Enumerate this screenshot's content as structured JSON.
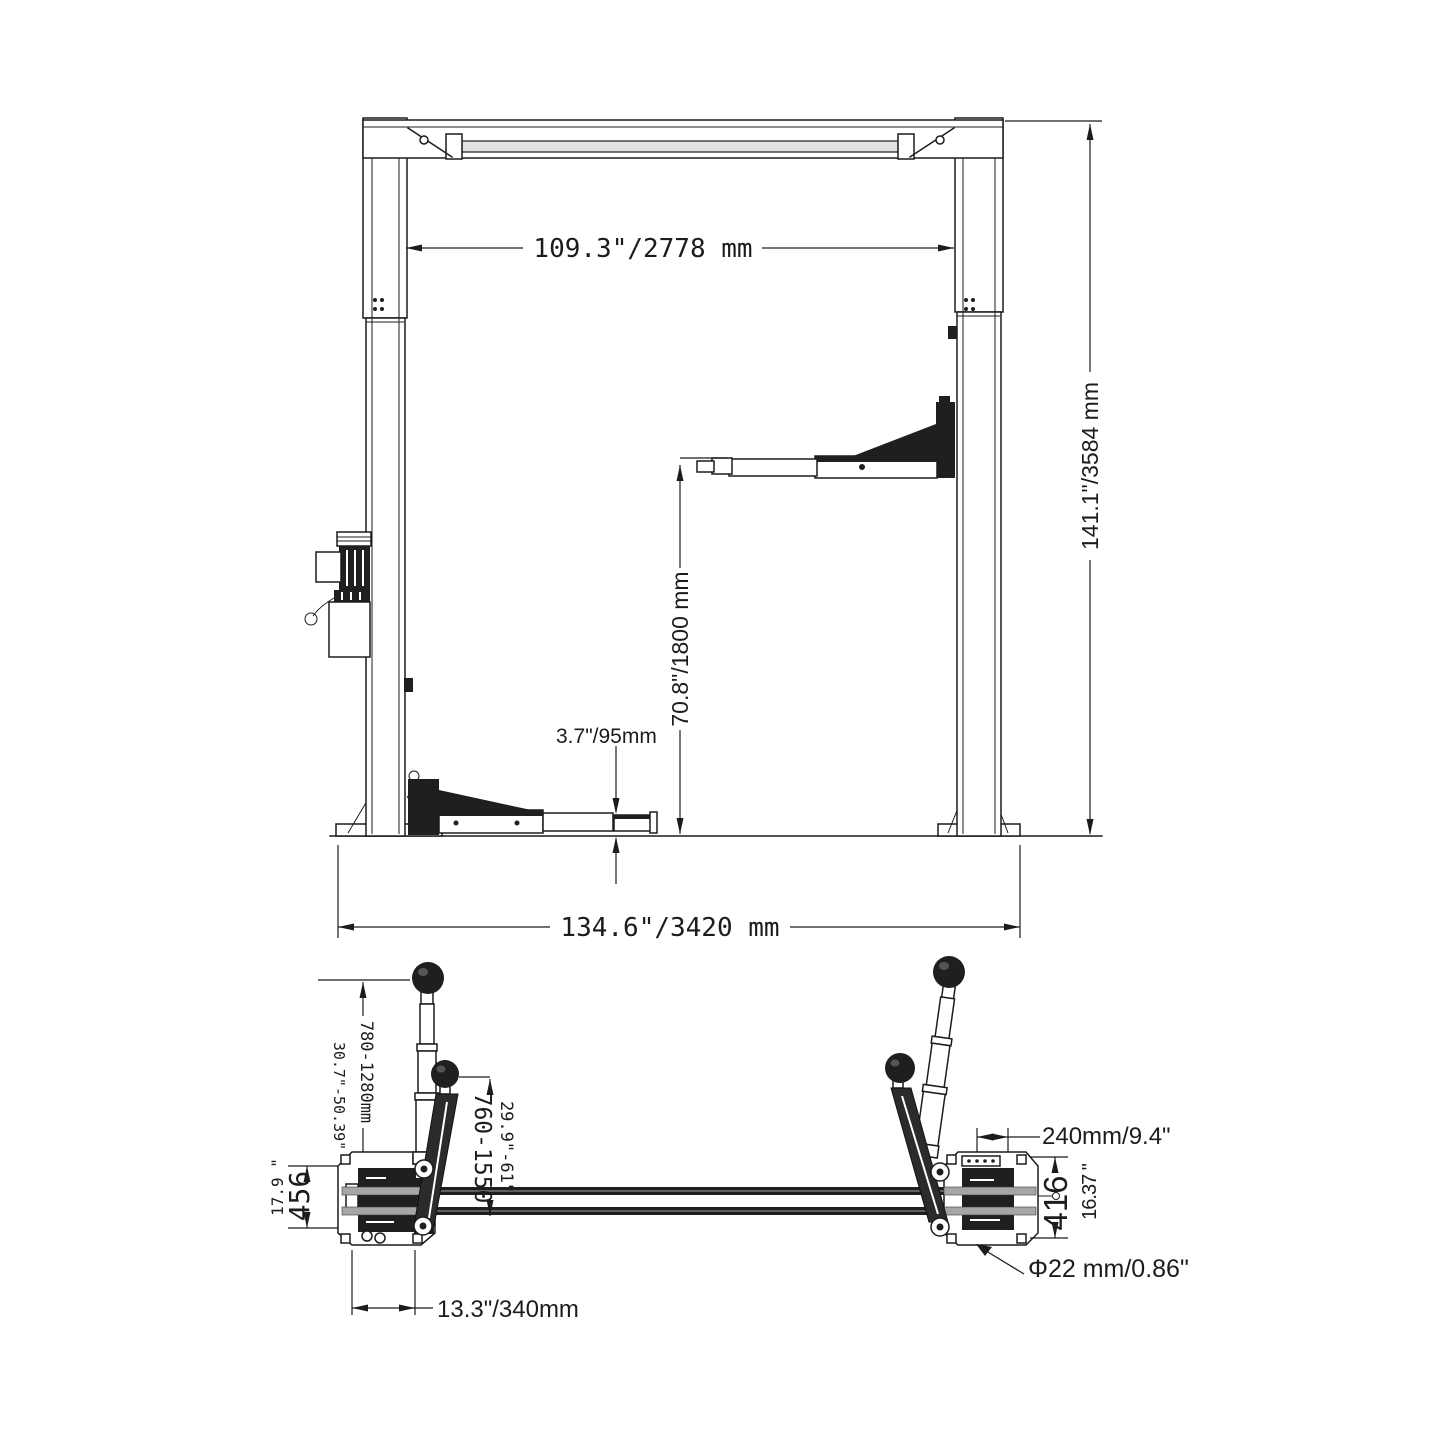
{
  "drawing": {
    "colors": {
      "line": "#1c1c1c",
      "dark_fill": "#1f1f1f",
      "rail_gray": "#a6a6a6",
      "background": "#ffffff"
    },
    "front_view": {
      "dim_inside_width": "109.3\"/2778 mm",
      "dim_overall_height": "141.1\"/3584 mm",
      "dim_lift_height": "70.8\"/1800 mm",
      "dim_pad_height": "3.7\"/95mm",
      "dim_overall_width": "134.6\"/3420 mm"
    },
    "plan_view": {
      "dim_front_arm_range_mm": "780-1280mm",
      "dim_front_arm_range_in": "30.7\"-50.39\"",
      "dim_rear_arm_range_mm": "760-1550",
      "dim_rear_arm_range_in": "29.9\"-61\"",
      "dim_base_depth_in": "17.9 \"",
      "dim_base_depth_mm": "456",
      "dim_base_width": "13.3\"/340mm",
      "dim_carriage_width": "240mm/9.4\"",
      "dim_plate_height_mm": "416",
      "dim_plate_height_in": "16.37 \"",
      "dim_anchor_hole": "Φ22 mm/0.86\""
    }
  }
}
